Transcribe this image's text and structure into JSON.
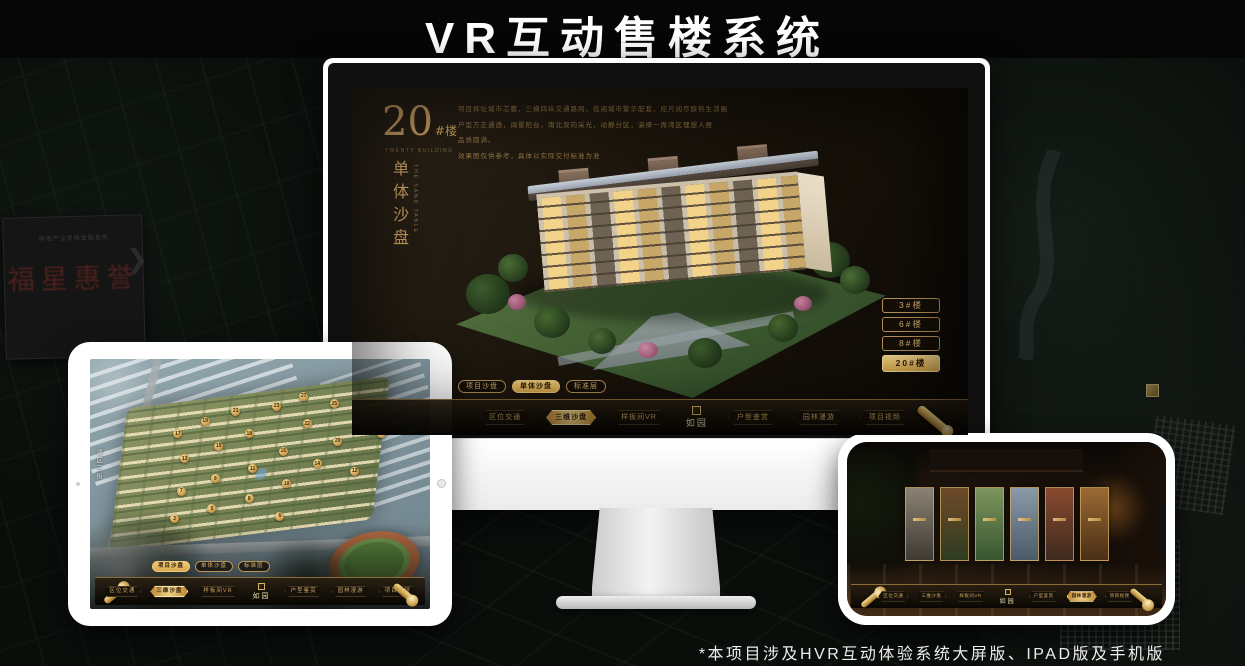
{
  "page": {
    "title": "VR互动售楼系统",
    "footnote": "*本项目涉及HVR互动体验系统大屏版、IPAD版及手机版"
  },
  "colors": {
    "gold": "#c9a063",
    "gold_bright": "#e6b95f",
    "screen_bg": "#171209",
    "nav_border": "#8a6c38"
  },
  "background": {
    "plaque_sub": "房地产业发展金融宣传",
    "plaque_main": "福星惠誉",
    "chevron": "❯"
  },
  "desktop": {
    "heading": {
      "number": "20",
      "suffix": "#楼",
      "caption": "TWENTY BUILDING",
      "vertical_title": "单体沙盘",
      "vertical_caption": "THE SAND TABLE"
    },
    "description_lines": [
      "项目择址城市芯麓，三横四纵交通路网，揽阅城市繁华配套，咫尺阅尽醇熟生活圈",
      "户型方正通透，阔景阳台，南北双向采光，动静分区，演绎一席湾区理想人居",
      "品质圆满。",
      "效果图仅供参考，具体以实际交付标准为准"
    ],
    "floor_buttons": [
      {
        "label": "3#楼",
        "selected": false
      },
      {
        "label": "6#楼",
        "selected": false
      },
      {
        "label": "8#楼",
        "selected": false
      },
      {
        "label": "20#楼",
        "selected": true
      }
    ],
    "view_tabs": [
      {
        "label": "项目沙盘",
        "selected": false
      },
      {
        "label": "单体沙盘",
        "selected": true
      },
      {
        "label": "标准层",
        "selected": false
      }
    ],
    "nav": {
      "left_items": [
        {
          "label": "区位交通",
          "selected": false
        },
        {
          "label": "三维沙盘",
          "selected": true
        },
        {
          "label": "样板间VR",
          "selected": false
        }
      ],
      "logo": "如园",
      "right_items": [
        {
          "label": "户型鉴赏",
          "selected": false
        },
        {
          "label": "园林漫游",
          "selected": false
        },
        {
          "label": "项目视频",
          "selected": false
        }
      ]
    }
  },
  "tablet": {
    "street_label": "湖区三街",
    "view_tabs": [
      {
        "label": "项目沙盘",
        "selected": true
      },
      {
        "label": "单体沙盘",
        "selected": false
      },
      {
        "label": "标准层",
        "selected": false
      }
    ],
    "nav": {
      "left_items": [
        {
          "label": "区位交通",
          "selected": false
        },
        {
          "label": "三维沙盘",
          "selected": true
        },
        {
          "label": "样板间VR",
          "selected": false
        }
      ],
      "logo": "如园",
      "right_items": [
        {
          "label": "户型鉴赏",
          "selected": false
        },
        {
          "label": "园林漫游",
          "selected": false
        },
        {
          "label": "项目视频",
          "selected": false
        }
      ]
    },
    "badges": [
      {
        "n": 27,
        "x": 63,
        "y": 15
      },
      {
        "n": 25,
        "x": 72,
        "y": 18
      },
      {
        "n": 23,
        "x": 55,
        "y": 19
      },
      {
        "n": 21,
        "x": 43,
        "y": 21
      },
      {
        "n": 26,
        "x": 81,
        "y": 22
      },
      {
        "n": 19,
        "x": 34,
        "y": 25
      },
      {
        "n": 22,
        "x": 64,
        "y": 26
      },
      {
        "n": 24,
        "x": 86,
        "y": 30
      },
      {
        "n": 17,
        "x": 26,
        "y": 30
      },
      {
        "n": 18,
        "x": 47,
        "y": 30
      },
      {
        "n": 20,
        "x": 73,
        "y": 33
      },
      {
        "n": 15,
        "x": 38,
        "y": 35
      },
      {
        "n": 16,
        "x": 57,
        "y": 37
      },
      {
        "n": 13,
        "x": 28,
        "y": 40
      },
      {
        "n": 14,
        "x": 67,
        "y": 42
      },
      {
        "n": 12,
        "x": 78,
        "y": 45
      },
      {
        "n": 11,
        "x": 48,
        "y": 44
      },
      {
        "n": 9,
        "x": 37,
        "y": 48
      },
      {
        "n": 10,
        "x": 58,
        "y": 50
      },
      {
        "n": 7,
        "x": 27,
        "y": 53
      },
      {
        "n": 8,
        "x": 47,
        "y": 56
      },
      {
        "n": 5,
        "x": 36,
        "y": 60
      },
      {
        "n": 6,
        "x": 56,
        "y": 63
      },
      {
        "n": 3,
        "x": 25,
        "y": 64
      }
    ]
  },
  "phone": {
    "cards": [
      {
        "colors": [
          "#8a8274",
          "#3f3b33"
        ]
      },
      {
        "colors": [
          "#6e4a28",
          "#2e3c22"
        ]
      },
      {
        "colors": [
          "#7e955e",
          "#37552f"
        ]
      },
      {
        "colors": [
          "#8b9aa8",
          "#4a5a68"
        ]
      },
      {
        "colors": [
          "#8a4a30",
          "#3e2a1e"
        ]
      },
      {
        "colors": [
          "#9a6a35",
          "#4a2e16"
        ]
      }
    ],
    "nav": {
      "left_items": [
        {
          "label": "区位交通",
          "selected": false
        },
        {
          "label": "三维沙盘",
          "selected": false
        },
        {
          "label": "样板间VR",
          "selected": false
        }
      ],
      "logo": "如园",
      "right_items": [
        {
          "label": "户型鉴赏",
          "selected": false
        },
        {
          "label": "园林漫游",
          "selected": true
        },
        {
          "label": "项目视频",
          "selected": false
        }
      ]
    }
  }
}
